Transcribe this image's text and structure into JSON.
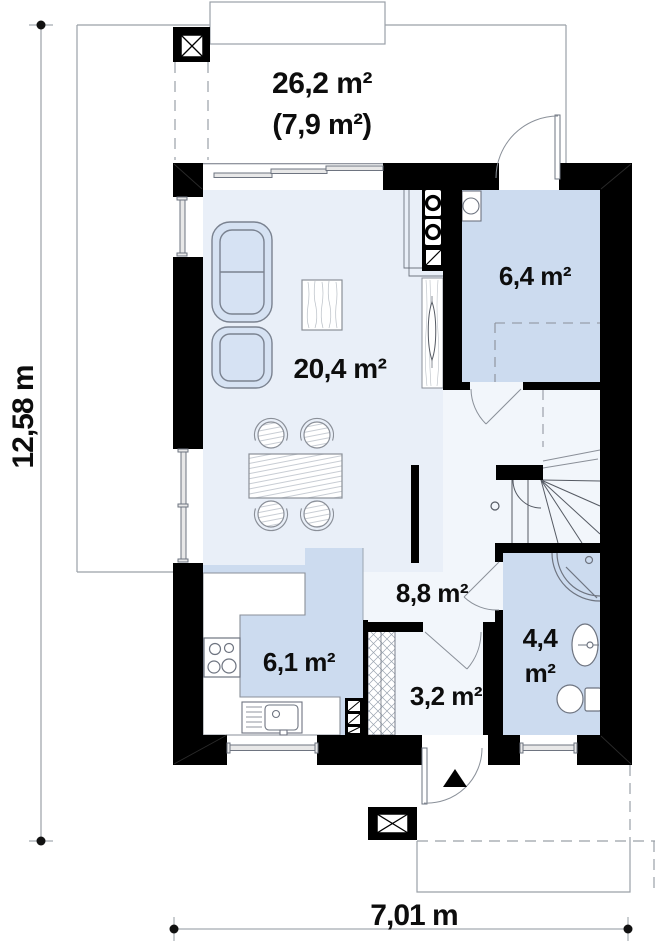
{
  "plan": {
    "type": "ground-floor plan",
    "labels": {
      "terrace_area": "26,2 m²",
      "terrace_area_secondary": "(7,9 m²)",
      "living_area": "20,4 m²",
      "utility_area": "6,4 m²",
      "hall_area": "8,8 m²",
      "kitchen_area": "6,1 m²",
      "vestibule_area": "3,2 m²",
      "bathroom_area_line1": "4,4",
      "bathroom_area_line2": "m²"
    },
    "dimensions": {
      "overall_height": "12,58 m",
      "overall_width": "7,01 m"
    },
    "colors": {
      "wall": "#000000",
      "room_fill": "#ccdbef",
      "living_fill": "#e9eff8",
      "hall_fill": "#f2f6fb",
      "furniture_fill": "#d6e2f3",
      "thin_line": "#6e7480",
      "dimension_line": "#b4b8bd"
    }
  }
}
